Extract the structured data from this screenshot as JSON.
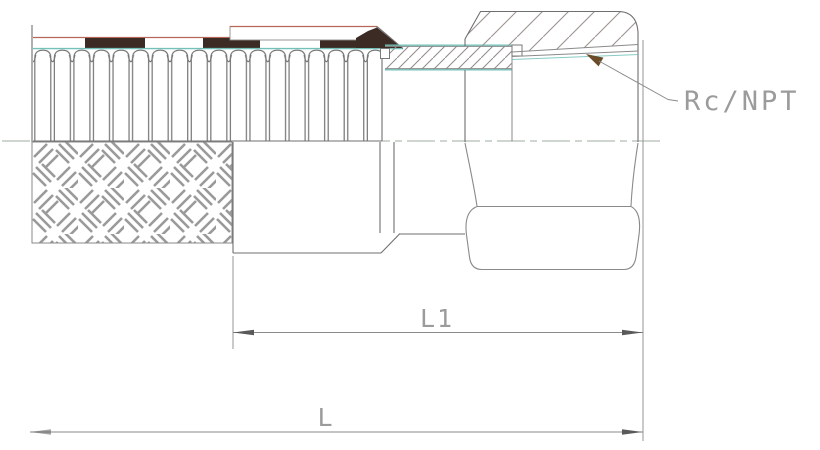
{
  "drawing": {
    "kind": "engineering-section-view",
    "subject": "corrugated flexible metal hose with braid, crimp socket and female swivel hex nut fitting",
    "labels": {
      "thread": "Rc/NPT",
      "dim_l1": "L1",
      "dim_l": "L"
    },
    "colors": {
      "background": "#ffffff",
      "line": "#6f6f6f",
      "line_light": "#8a8a8a",
      "centerline": "#9fae9f",
      "teal_accent": "#72c2ba",
      "band_dark": "#3c2a24",
      "band_red_edge": "#b5675c",
      "leader_arrow": "#6b4a28",
      "dim_arrow": "#5a5a5a",
      "dim_text": "#9b9b9b",
      "thread_text": "#a9a9a9",
      "hatch": "#948d8a",
      "weave": "#9a9a9a"
    }
  }
}
